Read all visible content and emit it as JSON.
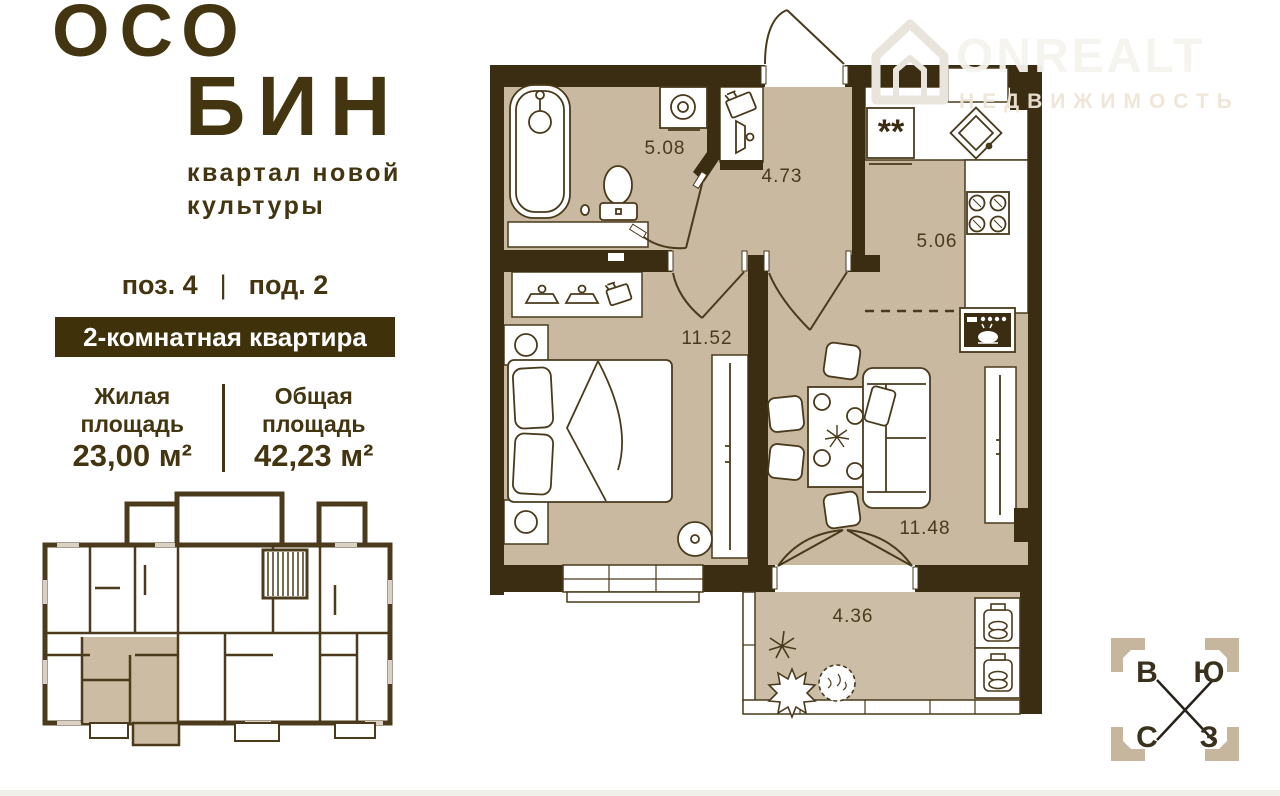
{
  "brand": {
    "title_line1": "ОСО",
    "title_line2": "БИН",
    "tagline_line1": "квартал новой",
    "tagline_line2": "культуры"
  },
  "unit": {
    "position": "поз. 4",
    "divider": "|",
    "entrance": "под. 2",
    "type_badge": "2-комнатная квартира",
    "living_area_label": "Жилая площадь",
    "living_area_value": "23,00 м²",
    "total_area_label": "Общая площадь",
    "total_area_value": "42,23 м²"
  },
  "floor_plan": {
    "bathroom_area": "5.08",
    "hallway_area": "4.73",
    "kitchen_area": "5.06",
    "bedroom_area": "11.52",
    "living_room_area": "11.48",
    "balcony_area": "4.36",
    "fridge_symbol": "**"
  },
  "compass": {
    "top_left": "В",
    "top_right": "Ю",
    "bottom_left": "С",
    "bottom_right": "З"
  },
  "watermark": {
    "brand": "ONREALT",
    "subtitle": "НЕДВИЖИМОСТЬ"
  },
  "colors": {
    "wall": "#3b2d12",
    "floor": "#c8b9a0",
    "text_dark": "#443511",
    "badge_bg": "#3f3109",
    "badge_text": "#ffffff",
    "compass_bracket": "#c6b69d"
  }
}
